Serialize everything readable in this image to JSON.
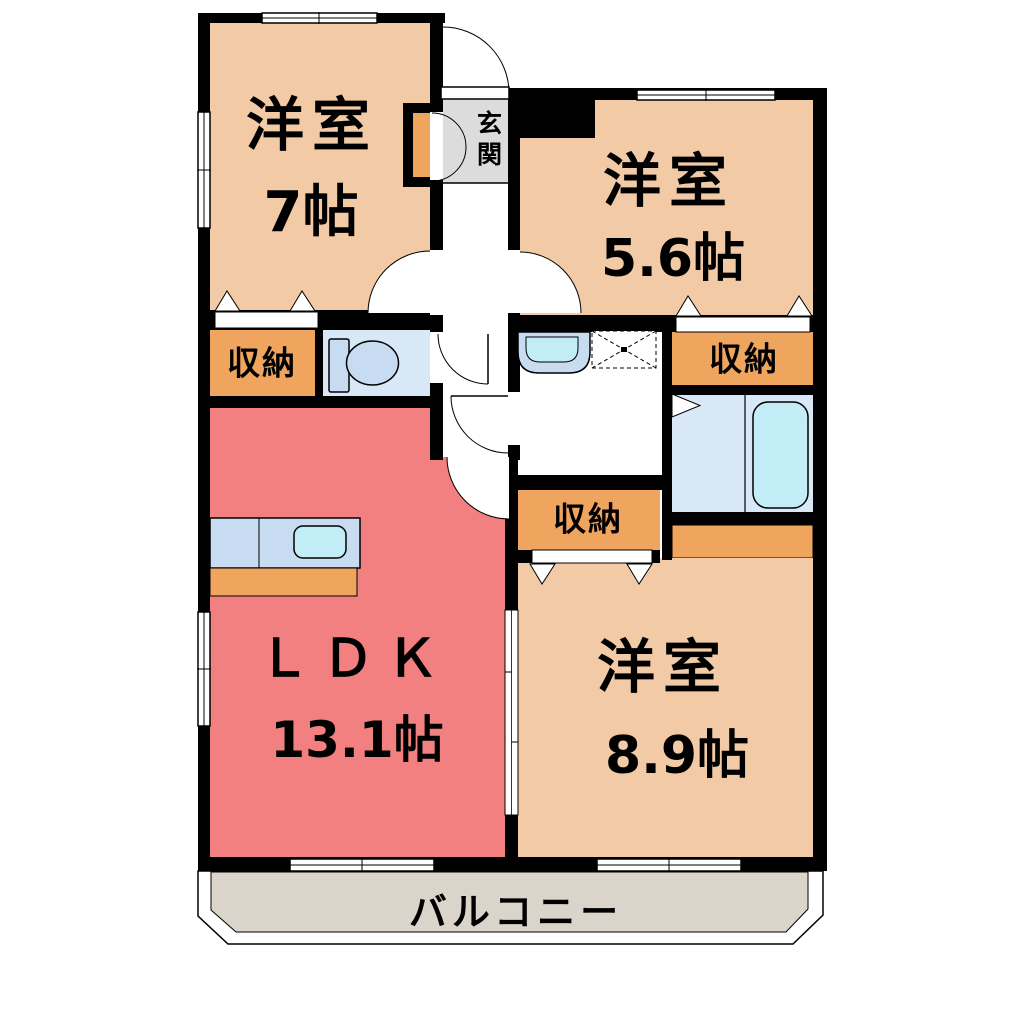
{
  "floor_plan": {
    "rooms": [
      {
        "name": "洋室",
        "size": "7帖"
      },
      {
        "name": "洋室",
        "size": "5.6帖"
      },
      {
        "name": "ＬＤＫ",
        "size": "13.1帖"
      },
      {
        "name": "洋室",
        "size": "8.9帖"
      }
    ],
    "entrance_label": "玄関",
    "storages": [
      "収納",
      "収納",
      "収納"
    ],
    "balcony_label": "バルコニー",
    "colors": {
      "room_fill": "#F2CBA6",
      "ldk_fill": "#F28080",
      "storage_fill": "#F0A55F",
      "wet_fill": "#D9E8F7",
      "fixture_fill": "#C7DCF0",
      "water_fill": "#C2EDF6",
      "entrance_fill": "#DCDCDC",
      "balcony_fill": "#DBD4CB",
      "wall": "#000000"
    }
  }
}
